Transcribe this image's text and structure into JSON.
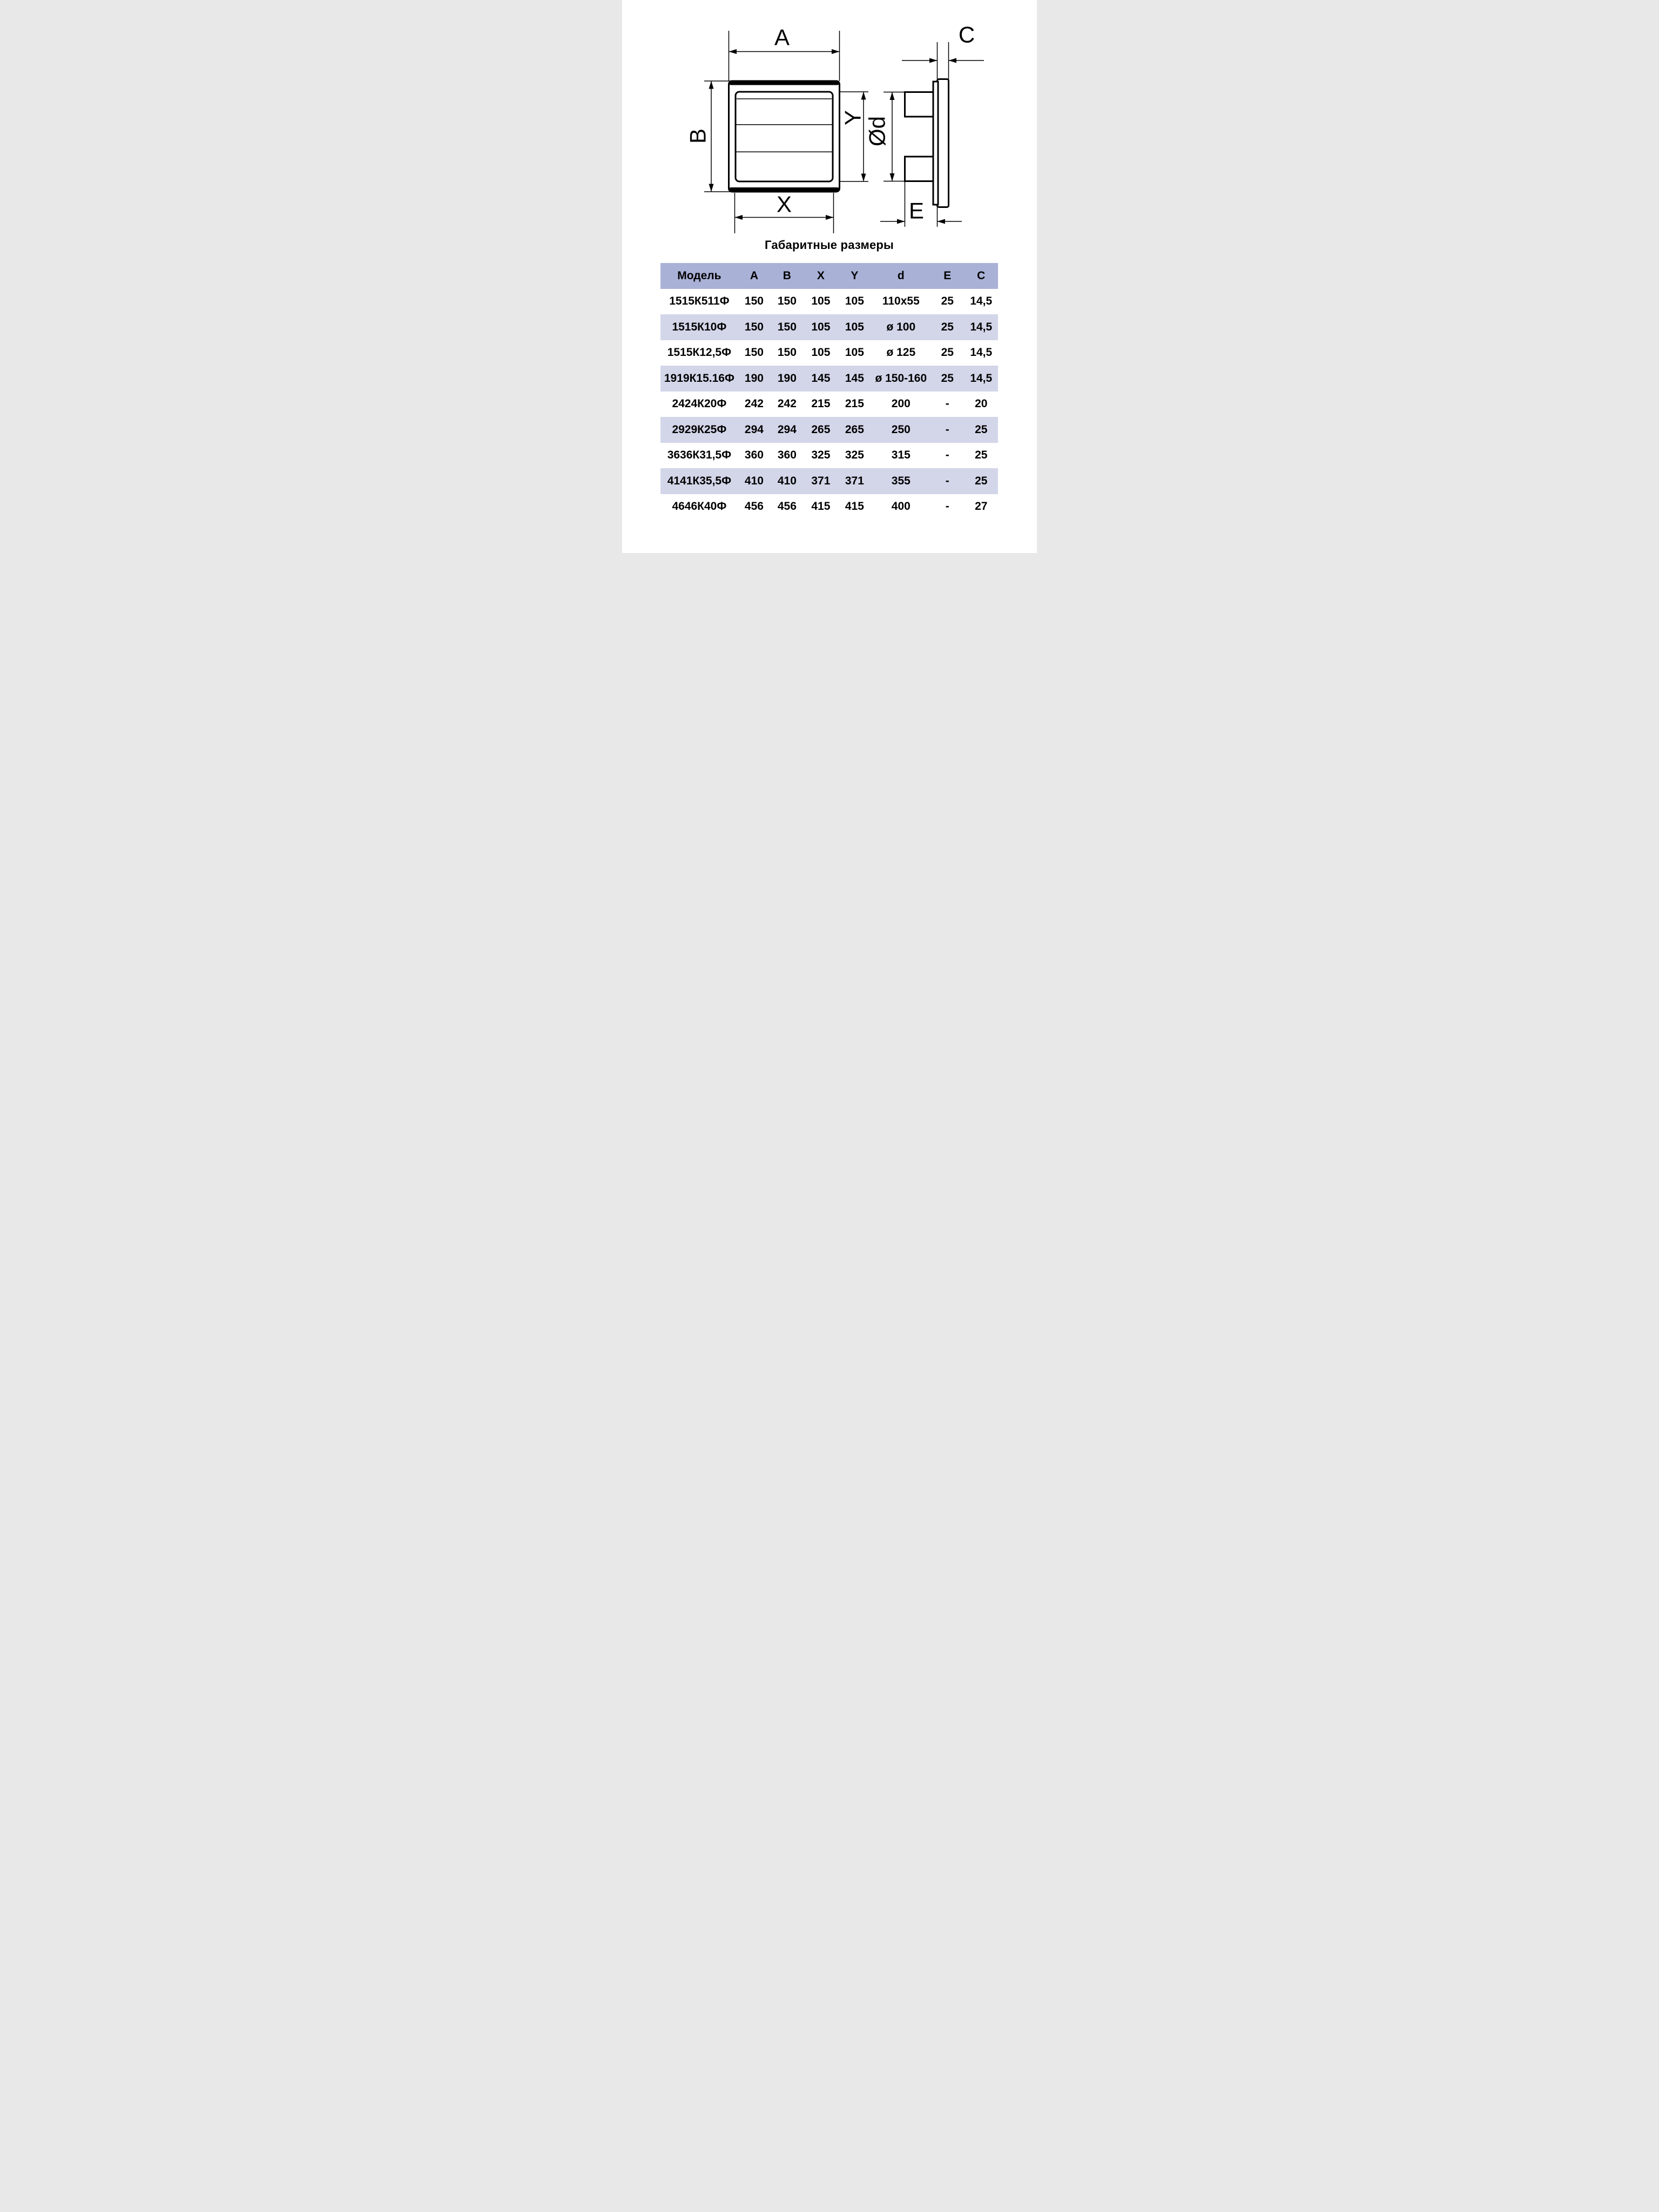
{
  "diagram": {
    "front_view": {
      "outer_width_label": "A",
      "outer_height_label": "B",
      "inner_width_label": "X",
      "inner_height_label": "Y"
    },
    "side_view": {
      "frame_depth_label": "C",
      "duct_diameter_label": "Ød",
      "duct_depth_label": "E"
    }
  },
  "table": {
    "title": "Габаритные размеры",
    "headers": [
      "Модель",
      "A",
      "B",
      "X",
      "Y",
      "d",
      "E",
      "C"
    ],
    "rows": [
      [
        "1515К511Ф",
        "150",
        "150",
        "105",
        "105",
        "110x55",
        "25",
        "14,5"
      ],
      [
        "1515К10Ф",
        "150",
        "150",
        "105",
        "105",
        "ø 100",
        "25",
        "14,5"
      ],
      [
        "1515К12,5Ф",
        "150",
        "150",
        "105",
        "105",
        "ø 125",
        "25",
        "14,5"
      ],
      [
        "1919К15.16Ф",
        "190",
        "190",
        "145",
        "145",
        "ø 150-160",
        "25",
        "14,5"
      ],
      [
        "2424К20Ф",
        "242",
        "242",
        "215",
        "215",
        "200",
        "-",
        "20"
      ],
      [
        "2929К25Ф",
        "294",
        "294",
        "265",
        "265",
        "250",
        "-",
        "25"
      ],
      [
        "3636К31,5Ф",
        "360",
        "360",
        "325",
        "325",
        "315",
        "-",
        "25"
      ],
      [
        "4141К35,5Ф",
        "410",
        "410",
        "371",
        "371",
        "355",
        "-",
        "25"
      ],
      [
        "4646К40Ф",
        "456",
        "456",
        "415",
        "415",
        "400",
        "-",
        "27"
      ]
    ]
  },
  "colors": {
    "header_bg": "#a9b1d6",
    "row_alt_bg": "#d3d6e9",
    "ink": "#000000",
    "background": "#ffffff"
  }
}
